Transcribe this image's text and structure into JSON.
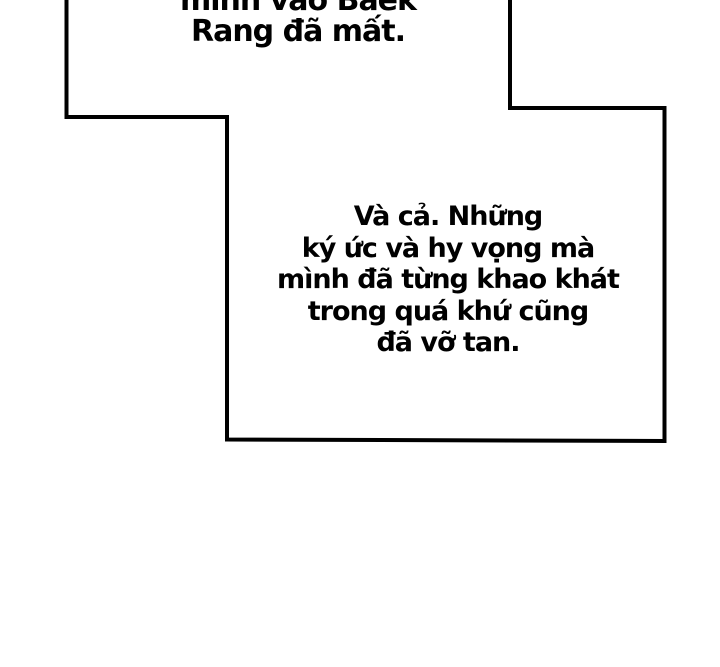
{
  "page": {
    "background_color": "#ffffff",
    "ink_color": "#000000"
  },
  "captions": {
    "top": {
      "lines": [
        "mình vào Baek",
        "Rang đã mất."
      ]
    },
    "main": {
      "lines": [
        "Và cả. Những",
        "ký ức và hy vọng mà",
        "mình đã từng khao khát",
        "trong quá khứ cũng",
        "đã vỡ tan."
      ]
    }
  }
}
